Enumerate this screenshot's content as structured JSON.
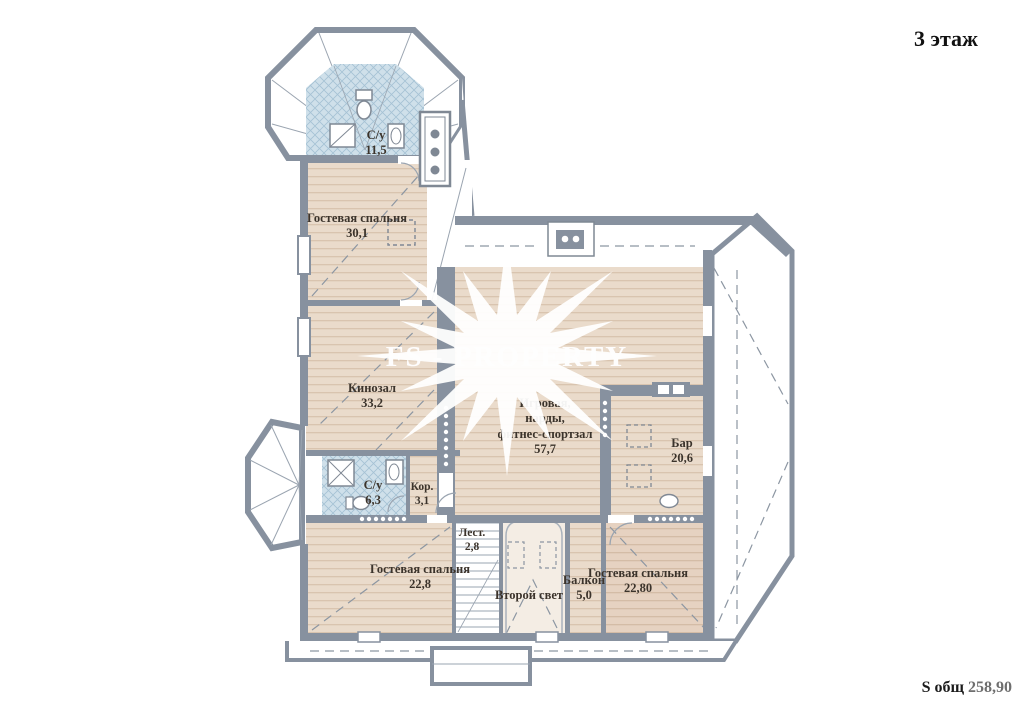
{
  "title": "3 этаж",
  "footer": {
    "label": "S общ",
    "value": "258,90"
  },
  "watermark": {
    "text": "FS - PROPERTY"
  },
  "rooms": {
    "bathroom_top": {
      "name": "С/у",
      "area": "11,5"
    },
    "guest_bedroom_top": {
      "name": "Гостевая спальня",
      "area": "30,1"
    },
    "cinema": {
      "name": "Кинозал",
      "area": "33,2"
    },
    "game_room": {
      "line1": "Игровая,",
      "line2": "нарды,",
      "line3": "фитнес-спортзал",
      "area": "57,7"
    },
    "bar": {
      "name": "Бар",
      "area": "20,6"
    },
    "bathroom_small": {
      "name": "С/у",
      "area": "6,3"
    },
    "corridor": {
      "name": "Кор.",
      "area": "3,1"
    },
    "stairs": {
      "name": "Лест.",
      "area": "2,8"
    },
    "guest_bedroom_left": {
      "name": "Гостевая спальня",
      "area": "22,8"
    },
    "void_space": {
      "name": "Второй свет"
    },
    "balcony": {
      "name": "Балкон",
      "area": "5,0"
    },
    "guest_bedroom_right": {
      "name": "Гостевая спальня",
      "area": "22,80"
    }
  },
  "colors": {
    "wall": "#87919f",
    "wood_floor": "#eadbcb",
    "wood_stripe": "#d9c4af",
    "wood_floor_dark": "#e6d2c1",
    "tile_blue": "#cfe0ea",
    "tile_line": "#a5c2d4",
    "void_floor": "#f4ede4",
    "label_text": "#3b332b",
    "watermark": "#ffffff"
  }
}
